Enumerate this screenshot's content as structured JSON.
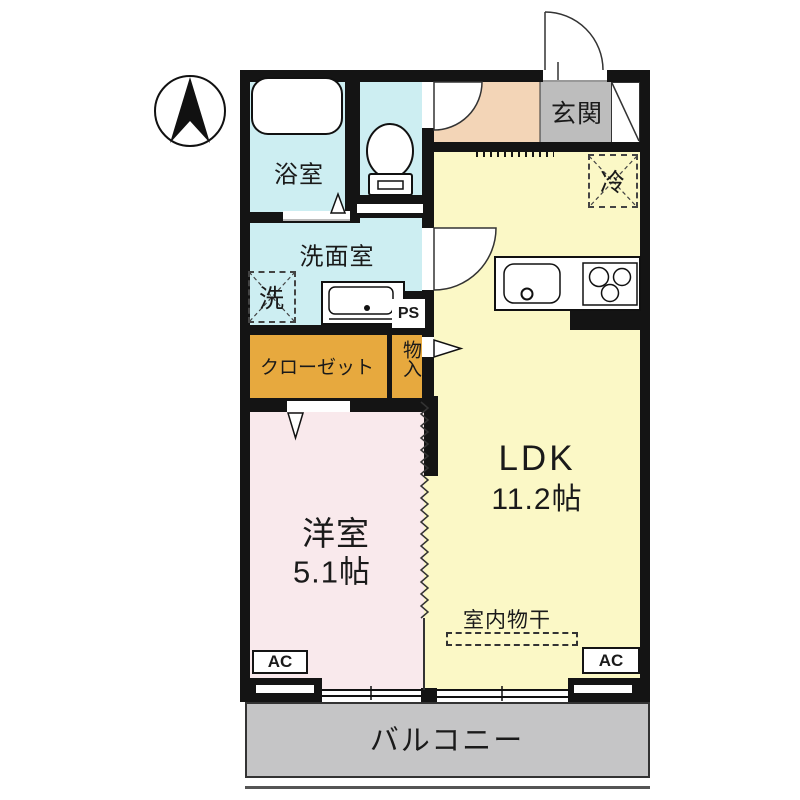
{
  "plan": {
    "compass": "N",
    "rooms": {
      "bathroom": "浴室",
      "washroom": "洗面室",
      "washer": "洗",
      "closet": "クローゼット",
      "storage": "物入",
      "pipe_space": "PS",
      "entrance": "玄関",
      "fridge": "冷",
      "ldk_name": "LDK",
      "ldk_size": "11.2帖",
      "western_name": "洋室",
      "western_size": "5.1帖",
      "indoor_drying": "室内物干",
      "ac_left": "AC",
      "ac_right": "AC",
      "balcony": "バルコニー"
    },
    "colors": {
      "wet_area": "#cdeef2",
      "hall": "#f3d5b7",
      "entrance_floor": "#bdbdbd",
      "ldk": "#fbf8c6",
      "western_room": "#f9e9ec",
      "closet": "#e7a93e",
      "balcony": "#c5c5c6",
      "wall": "#141414"
    }
  }
}
